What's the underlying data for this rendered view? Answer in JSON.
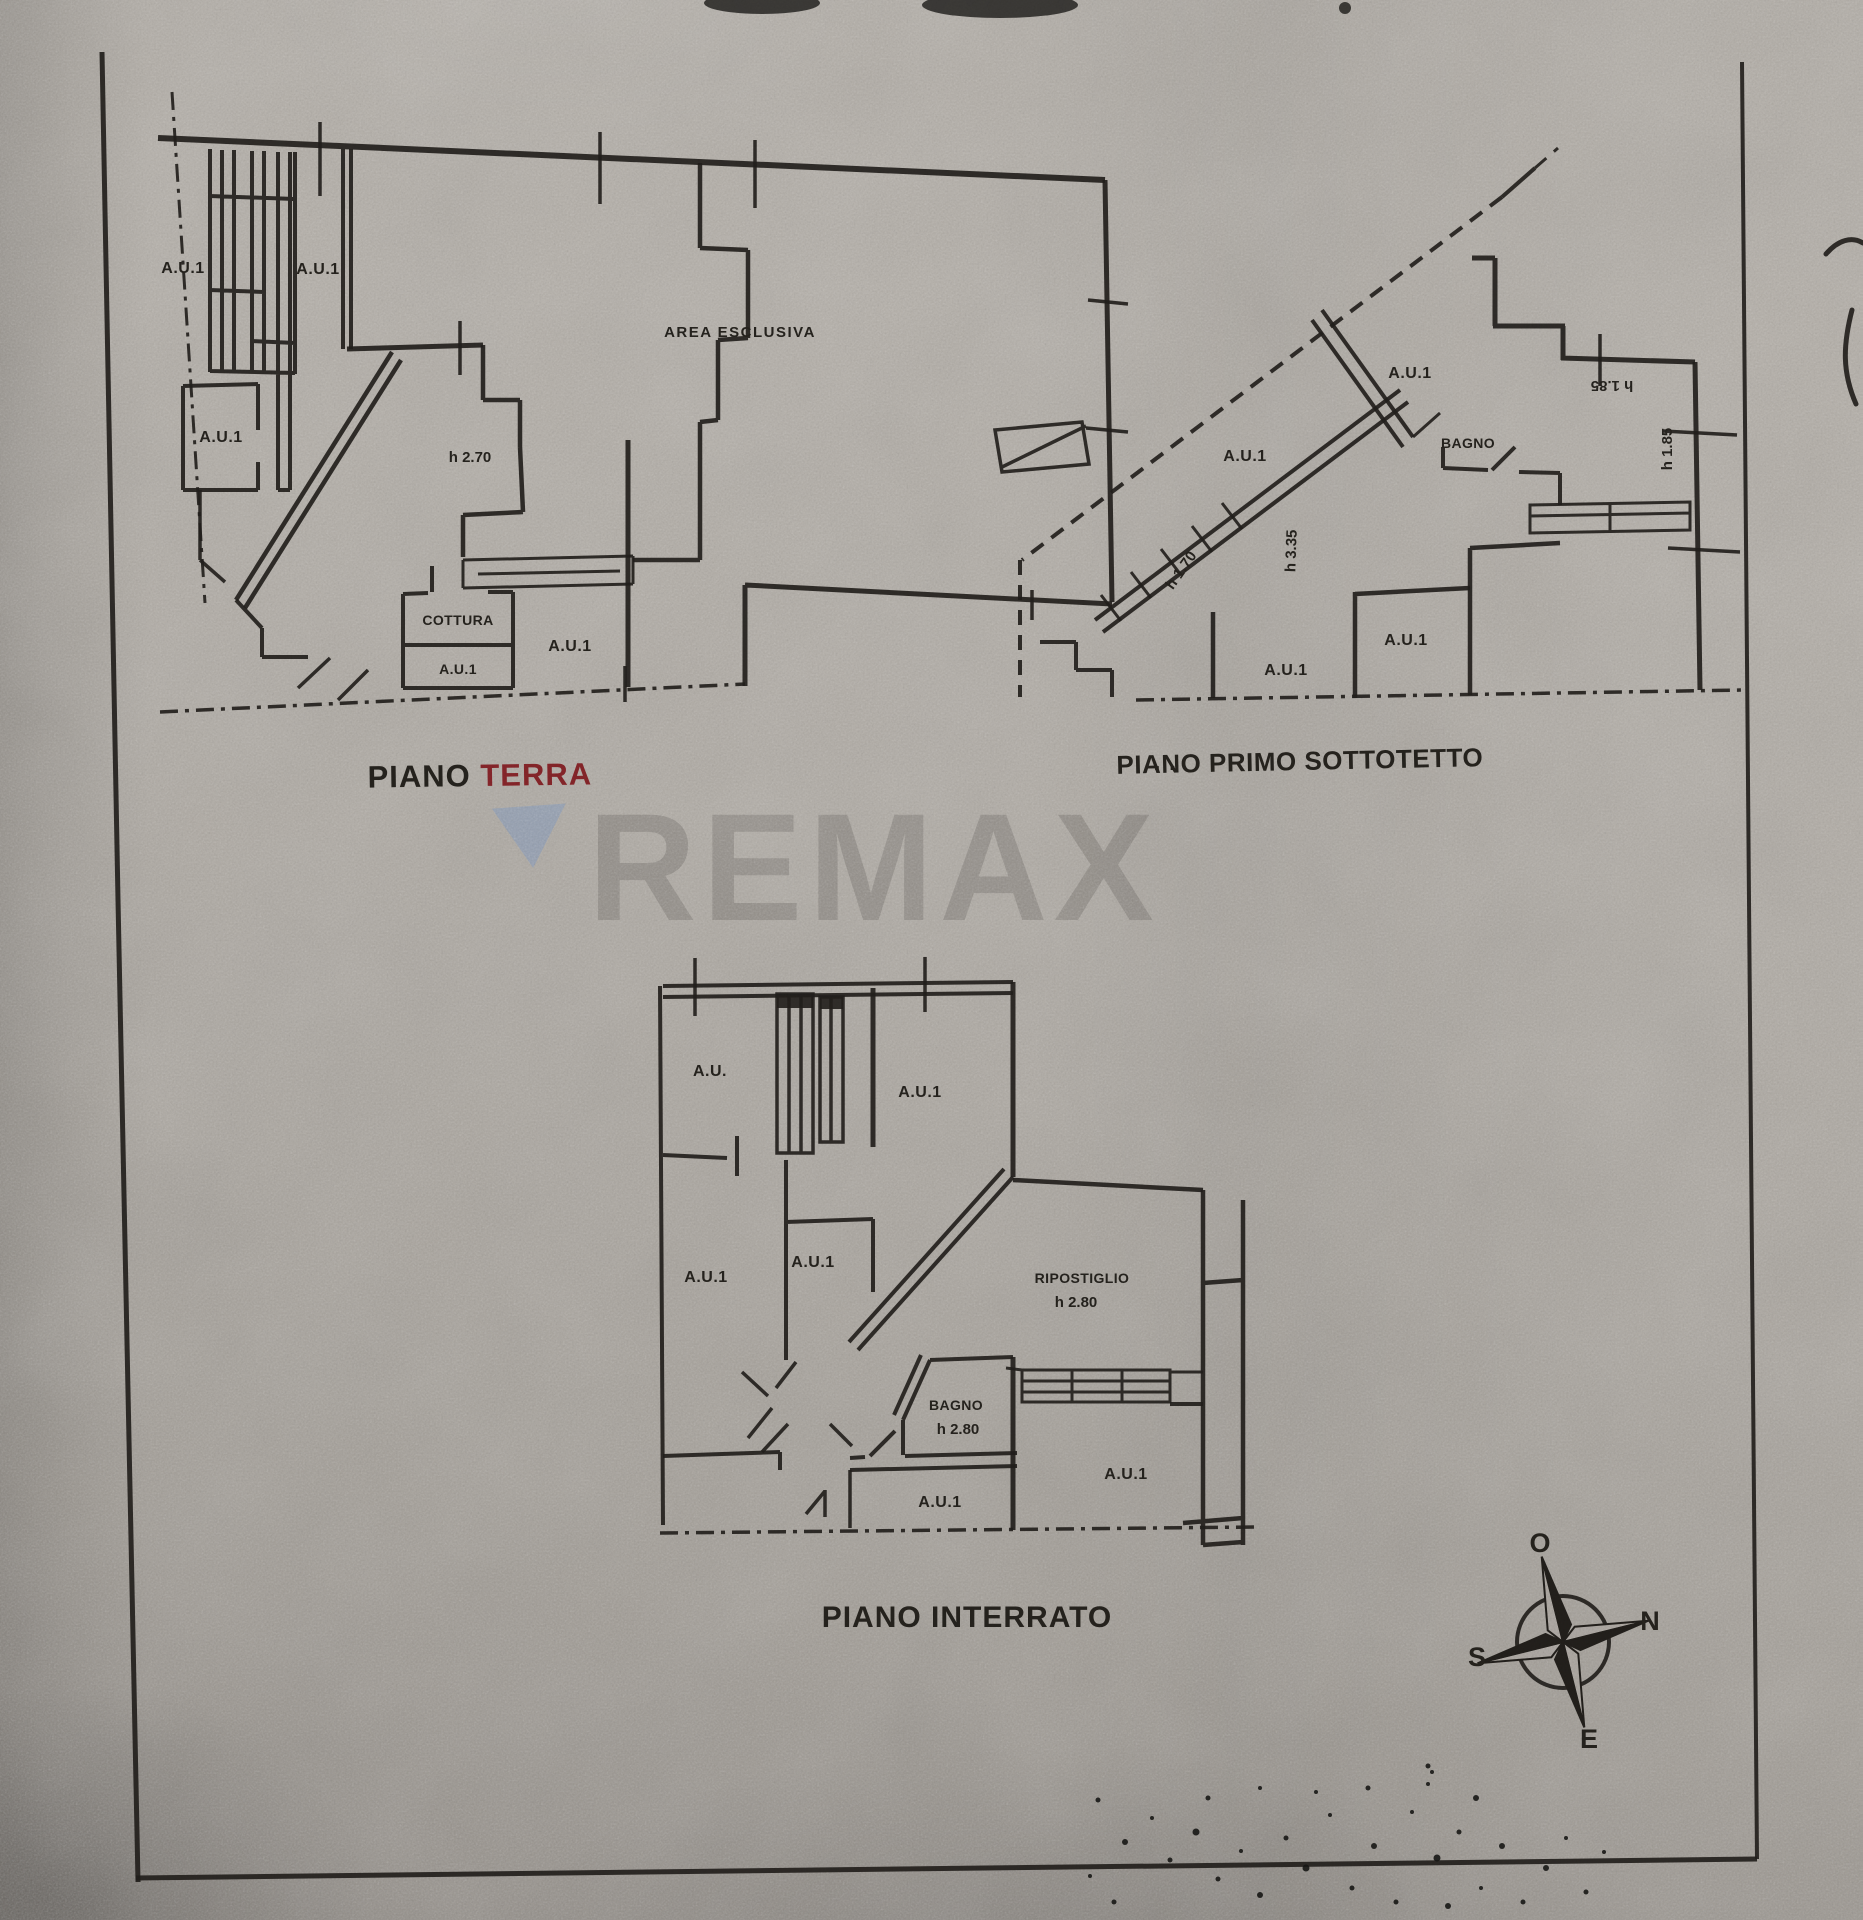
{
  "page": {
    "paper_color": "#afaaa3",
    "ink_color": "#23201c",
    "accent_red": "#8b262b"
  },
  "watermark": {
    "text": "REMAX",
    "letter_color": "#66625c",
    "triangle_color": "#8098ba"
  },
  "plans": {
    "terra": {
      "title_main": "PIANO ",
      "title_accent": "TERRA",
      "labels": {
        "room_tl": "A.U.1",
        "room_tm": "A.U.1",
        "room_lm": "A.U.1",
        "height": "h 2.70",
        "area": "AREA ESCLUSIVA",
        "cottura": "COTTURA",
        "room_b1": "A.U.1",
        "room_b2": "A.U.1"
      }
    },
    "sottotetto": {
      "title": "PIANO PRIMO SOTTOTETTO",
      "title_dots": ". .",
      "labels": {
        "room_top": "A.U.1",
        "bagno": "BAGNO",
        "band": "A.U.1",
        "h_top": "h 1.85",
        "h_right": "h 1.85",
        "h_mid": "h 3.35",
        "h_stair": "h 1.70",
        "room_b1": "A.U.1",
        "room_b2": "A.U.1"
      }
    },
    "interrato": {
      "title": "PIANO INTERRATO",
      "labels": {
        "room_tl": "A.U.",
        "room_tr": "A.U.1",
        "room_l": "A.U.1",
        "room_c": "A.U.1",
        "ripostiglio": "RIPOSTIGLIO",
        "ripostiglio_h": "h 2.80",
        "bagno": "BAGNO",
        "bagno_h": "h 2.80",
        "room_b1": "A.U.1",
        "room_b2": "A.U.1"
      }
    }
  },
  "compass": {
    "west": "O",
    "north": "N",
    "south": "S",
    "east": "E"
  }
}
